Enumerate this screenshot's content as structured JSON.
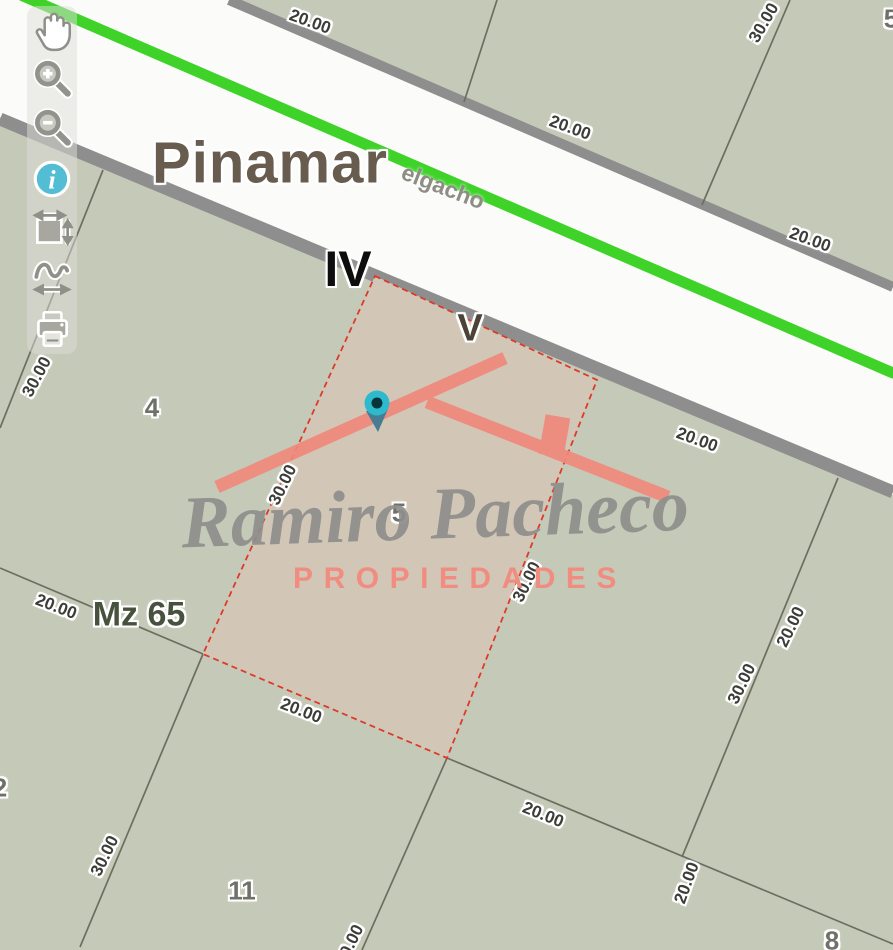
{
  "map": {
    "city_label": "Pinamar",
    "street_label": "elgacho",
    "zone_iv": "IV",
    "zone_v": "V",
    "block_label": "Mz 65",
    "parcel_numbers": {
      "p4": "4",
      "p5": "5",
      "p11": "11",
      "p8": "8",
      "p2": "2",
      "edge": "5"
    },
    "dims": [
      "20.00",
      "30.00",
      "20.00",
      "20.00",
      "30.00",
      "20.00",
      "30.00",
      "30.00",
      "20.00",
      "20.00",
      "30.00",
      "20.00",
      "20.00",
      "20.00",
      "30.00",
      "30.00"
    ]
  },
  "watermark": {
    "script_name": "Ramiro Pacheco",
    "subtitle": "PROPIEDADES"
  },
  "toolbar": {
    "info_glyph": "i",
    "tools": [
      {
        "name": "pan"
      },
      {
        "name": "zoom-in"
      },
      {
        "name": "zoom-out"
      },
      {
        "name": "info"
      },
      {
        "name": "measure-extent"
      },
      {
        "name": "measure-path"
      },
      {
        "name": "print"
      }
    ]
  },
  "colors": {
    "block_fill": "#c5c9b8",
    "road_fill": "#fbfbf9",
    "road_casing": "#8e8e8e",
    "route_green": "#3fd32a",
    "parcel_line": "#6e6e60",
    "selected_parcel_fill": "#d2c7b7",
    "selected_parcel_border": "#dd3a2a",
    "brand_salmon": "#f0897c",
    "marker_teal": "#2eb9cc"
  }
}
